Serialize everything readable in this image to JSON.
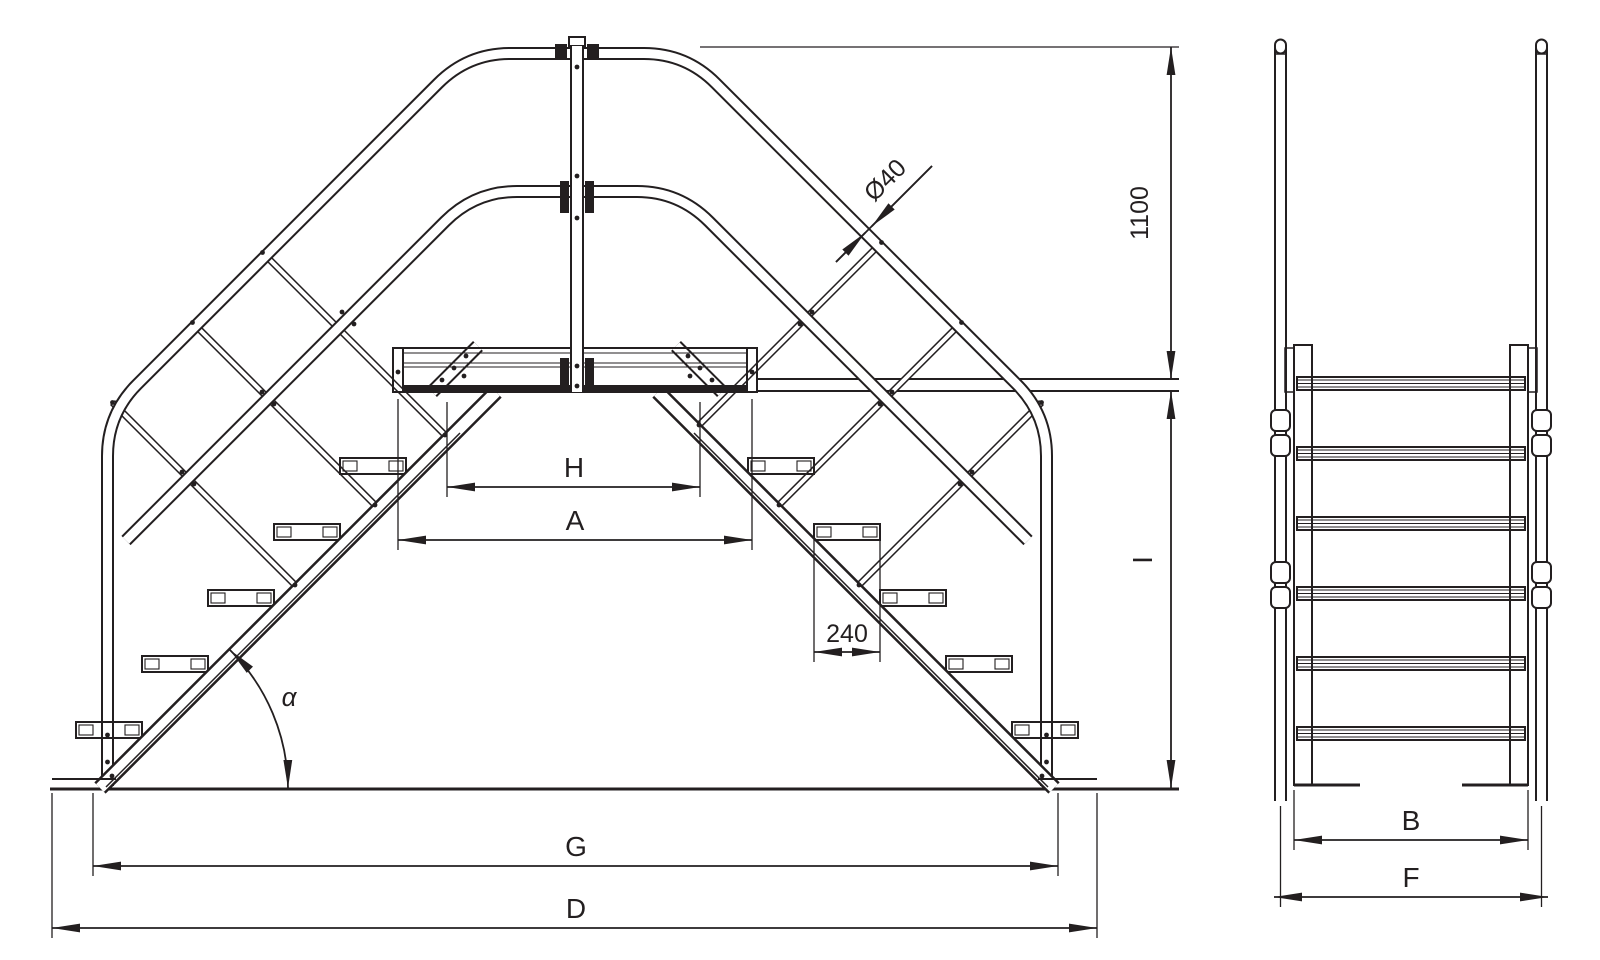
{
  "diagram": {
    "type": "technical-drawing",
    "subject": "crossover platform stairs with handrails, orthographic projection",
    "background_color": "#ffffff",
    "line_color": "#231f20",
    "views": [
      {
        "id": "side-elevation"
      },
      {
        "id": "front-elevation"
      }
    ],
    "dimensions": [
      {
        "id": "tube-diameter",
        "label": "Ø40",
        "value": 40,
        "unit": "mm",
        "orientation": "diagonal"
      },
      {
        "id": "handrail-height",
        "label": "1100",
        "value": 1100,
        "unit": "mm",
        "orientation": "vertical"
      },
      {
        "id": "clear-width-H",
        "label": "H",
        "orientation": "horizontal"
      },
      {
        "id": "platform-width-A",
        "label": "A",
        "orientation": "horizontal"
      },
      {
        "id": "tread-depth",
        "label": "240",
        "value": 240,
        "unit": "mm",
        "orientation": "horizontal"
      },
      {
        "id": "incline-angle",
        "label": "α",
        "orientation": "angular"
      },
      {
        "id": "span-G",
        "label": "G",
        "orientation": "horizontal"
      },
      {
        "id": "overall-length-D",
        "label": "D",
        "orientation": "horizontal"
      },
      {
        "id": "platform-height-I",
        "label": "I",
        "orientation": "vertical"
      },
      {
        "id": "inner-width-B",
        "label": "B",
        "orientation": "horizontal"
      },
      {
        "id": "overall-width-F",
        "label": "F",
        "orientation": "horizontal"
      }
    ]
  }
}
